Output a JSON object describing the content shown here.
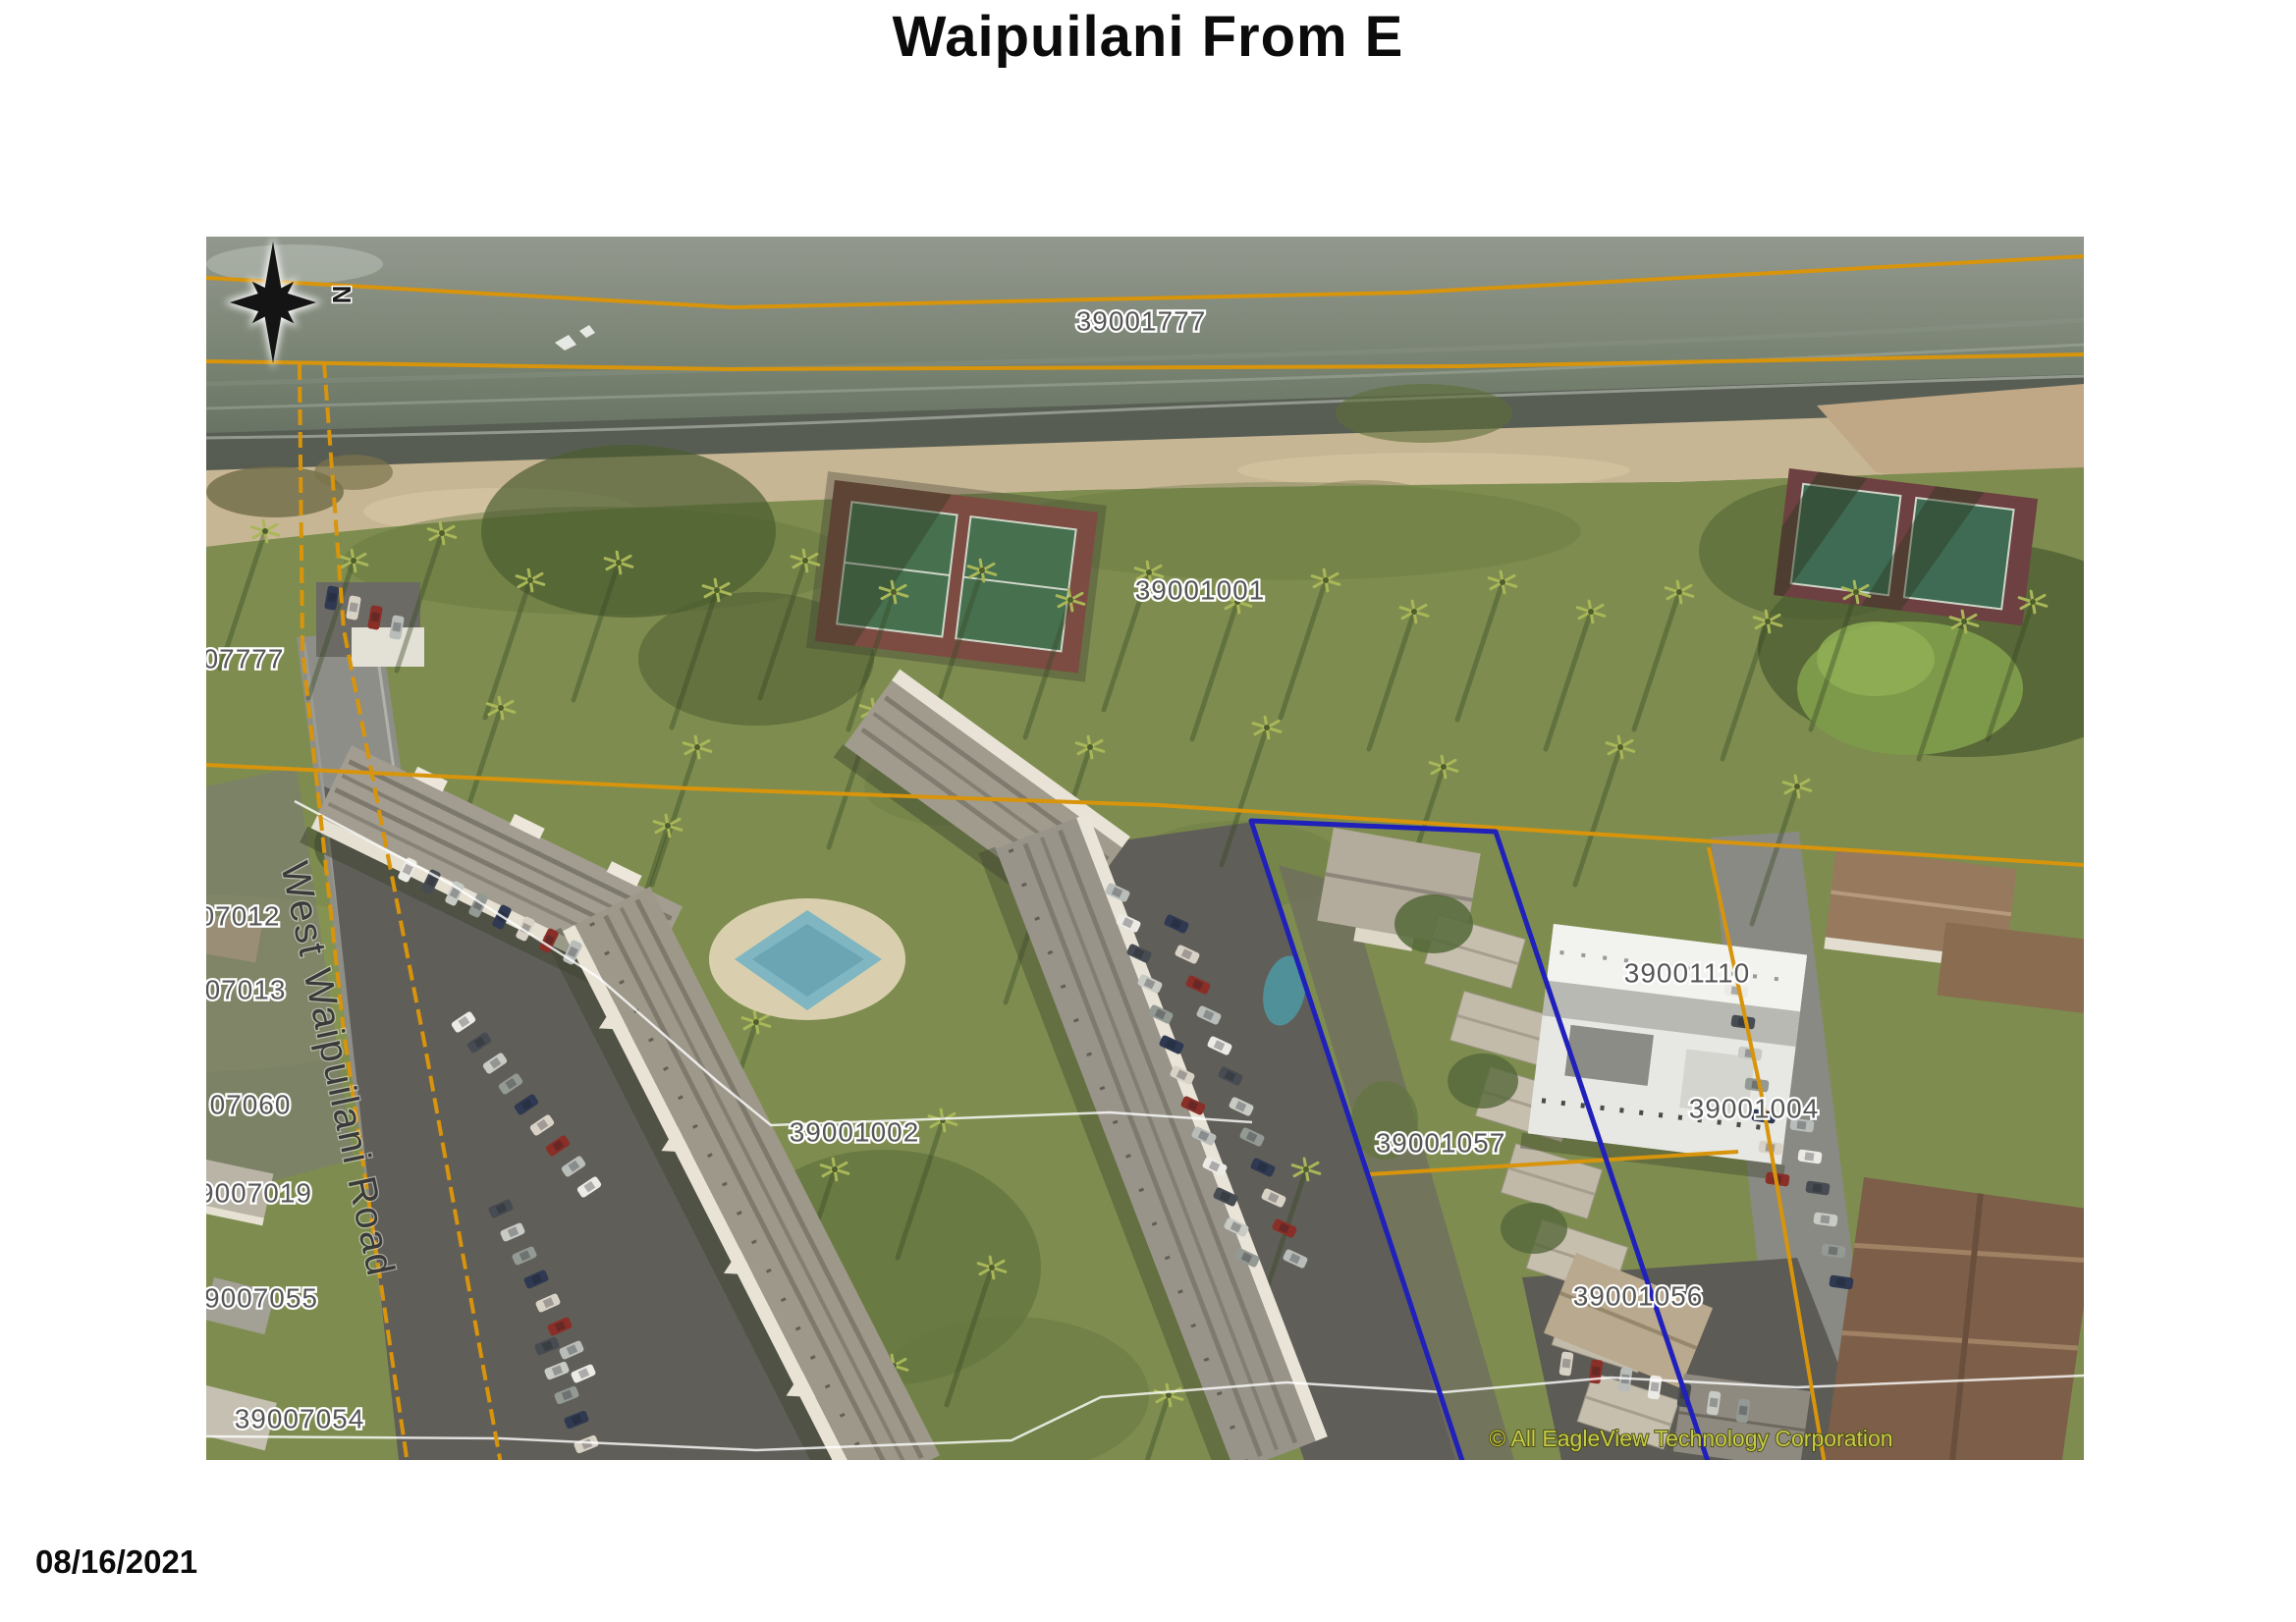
{
  "page": {
    "title": "Waipuilani From E",
    "date": "08/16/2021"
  },
  "map": {
    "compass": "N",
    "road_label": "West Waipuilani Road",
    "copyright": "© All EagleView Technology Corporation",
    "parcels": [
      {
        "id": "39001777"
      },
      {
        "id": "39001001"
      },
      {
        "id": "07777"
      },
      {
        "id": "07012"
      },
      {
        "id": "07013"
      },
      {
        "id": "07060"
      },
      {
        "id": "9007019"
      },
      {
        "id": "9007055"
      },
      {
        "id": "39007054"
      },
      {
        "id": "39001002"
      },
      {
        "id": "39001057"
      },
      {
        "id": "39001110"
      },
      {
        "id": "39001004"
      },
      {
        "id": "39001056"
      }
    ],
    "colors": {
      "parcel_line_orange": "#d8940b",
      "highlight_parcel_blue": "#2020bb",
      "parcel_label_fill": "#565656",
      "copyright_text": "#c6cc49"
    }
  }
}
